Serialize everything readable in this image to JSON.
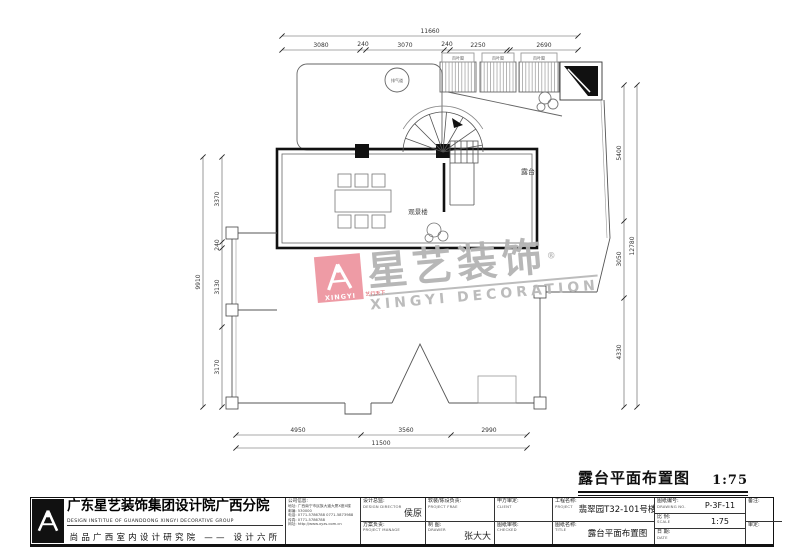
{
  "watermark": {
    "brand": "星艺装饰",
    "brand_en": "XINGYI DECORATION",
    "logo_text": "XINGYI",
    "tagline": "艺行天下",
    "reg": "®",
    "logo_color": "#ee96a1",
    "text_color": "#b4b4b4"
  },
  "drawing_title": {
    "text": "露台平面布置图",
    "scale": "1:75"
  },
  "labels": {
    "viewing_room": "观景楼",
    "terrace": "露台",
    "vent": "排气道",
    "louvers": [
      "百叶窗",
      "百叶窗",
      "百叶窗"
    ]
  },
  "dims": {
    "top": {
      "total": "11660",
      "segments": [
        "3080",
        "240",
        "3070",
        "240",
        "2250",
        "2690"
      ]
    },
    "bottom": {
      "total": "11500",
      "segments": [
        "4950",
        "3560",
        "2990"
      ]
    },
    "left": {
      "total": "9910",
      "segments": [
        "3370",
        "240",
        "3130",
        "3170"
      ]
    },
    "right": {
      "total": "12780",
      "segments": [
        "5400",
        "3050",
        "4330"
      ]
    }
  },
  "title_block": {
    "company_cn": "广东星艺装饰集团设计院广西分院",
    "company_en": "DESIGN INSTITUE OF GUANDDONG XINGYI DECORATIVE GROUP",
    "company_sub": "尚品广西室内设计研究院 —— 设计六所",
    "info": {
      "heading": "公司信息:",
      "line1": "地址: 广西南宁市民族大道大厦X座X楼",
      "line2": "邮编: 530000",
      "line3": "电话: 0771-5786788  0771-5873988",
      "line4": "传真: 0771-5786788",
      "line5": "网址: http://www.xyzs.com.cn"
    },
    "cells": {
      "design_director_label": "设计总监:",
      "design_director_en": "DESIGN DIRECTOR",
      "design_director_name": "侯原",
      "project_manager_label": "方案负责:",
      "project_manager_en": "PROJECT MANAGE",
      "deco_label": "软装/陈设负责:",
      "deco_en": "PROJECT FRAE",
      "drawer_label": "制 图:",
      "drawer_en": "DRAWER",
      "drawer_name": "张大大",
      "client_label": "甲方审定:",
      "client_en": "CLIENT",
      "checked_label": "图纸审核:",
      "checked_en": "CHECKED",
      "project_label": "工程名称:",
      "project_en": "PROJECT",
      "project_value": "翡翠园T32-101号楼",
      "title_label": "图纸名称:",
      "title_en": "TITLE",
      "title_value": "露台平面布置图",
      "no_label": "图纸编号:",
      "no_en": "DRAWING NO.",
      "no_value": "P-3F-11",
      "scale_label": "比 例:",
      "scale_en": "SCALE",
      "scale_value": "1:75",
      "date_label": "日 期:",
      "date_en": "DATE",
      "remark_label": "备注:",
      "approve_label": "审定:"
    }
  }
}
